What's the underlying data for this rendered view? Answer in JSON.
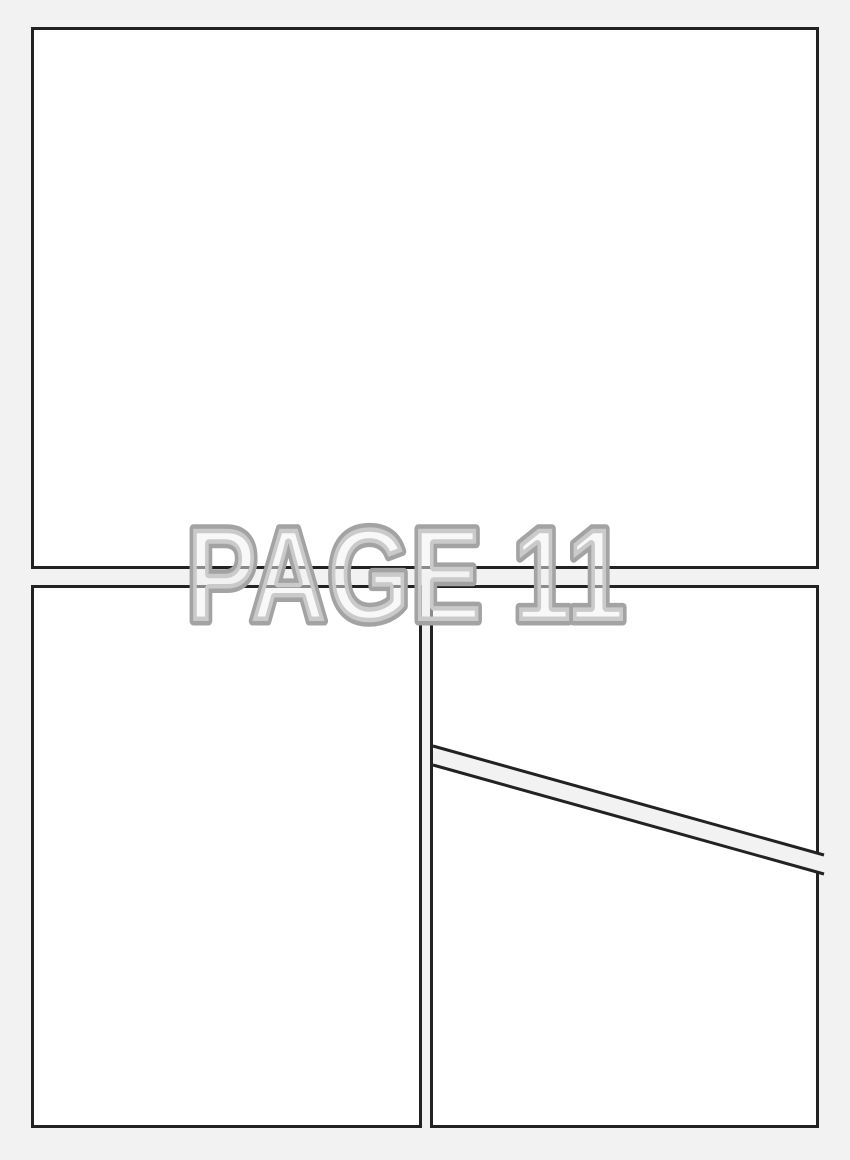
{
  "page": {
    "watermark_text": "PAGE 11"
  },
  "colors": {
    "bg": "#f2f2f2",
    "panel": "#ffffff",
    "border": "#222222",
    "wm-stroke": "#a3a3a3",
    "wm-fill": "#f2f2f2"
  },
  "panels": {
    "count": 4,
    "layout": [
      "full-width-top",
      "bottom-left",
      "bottom-right-upper",
      "bottom-right-lower"
    ]
  }
}
